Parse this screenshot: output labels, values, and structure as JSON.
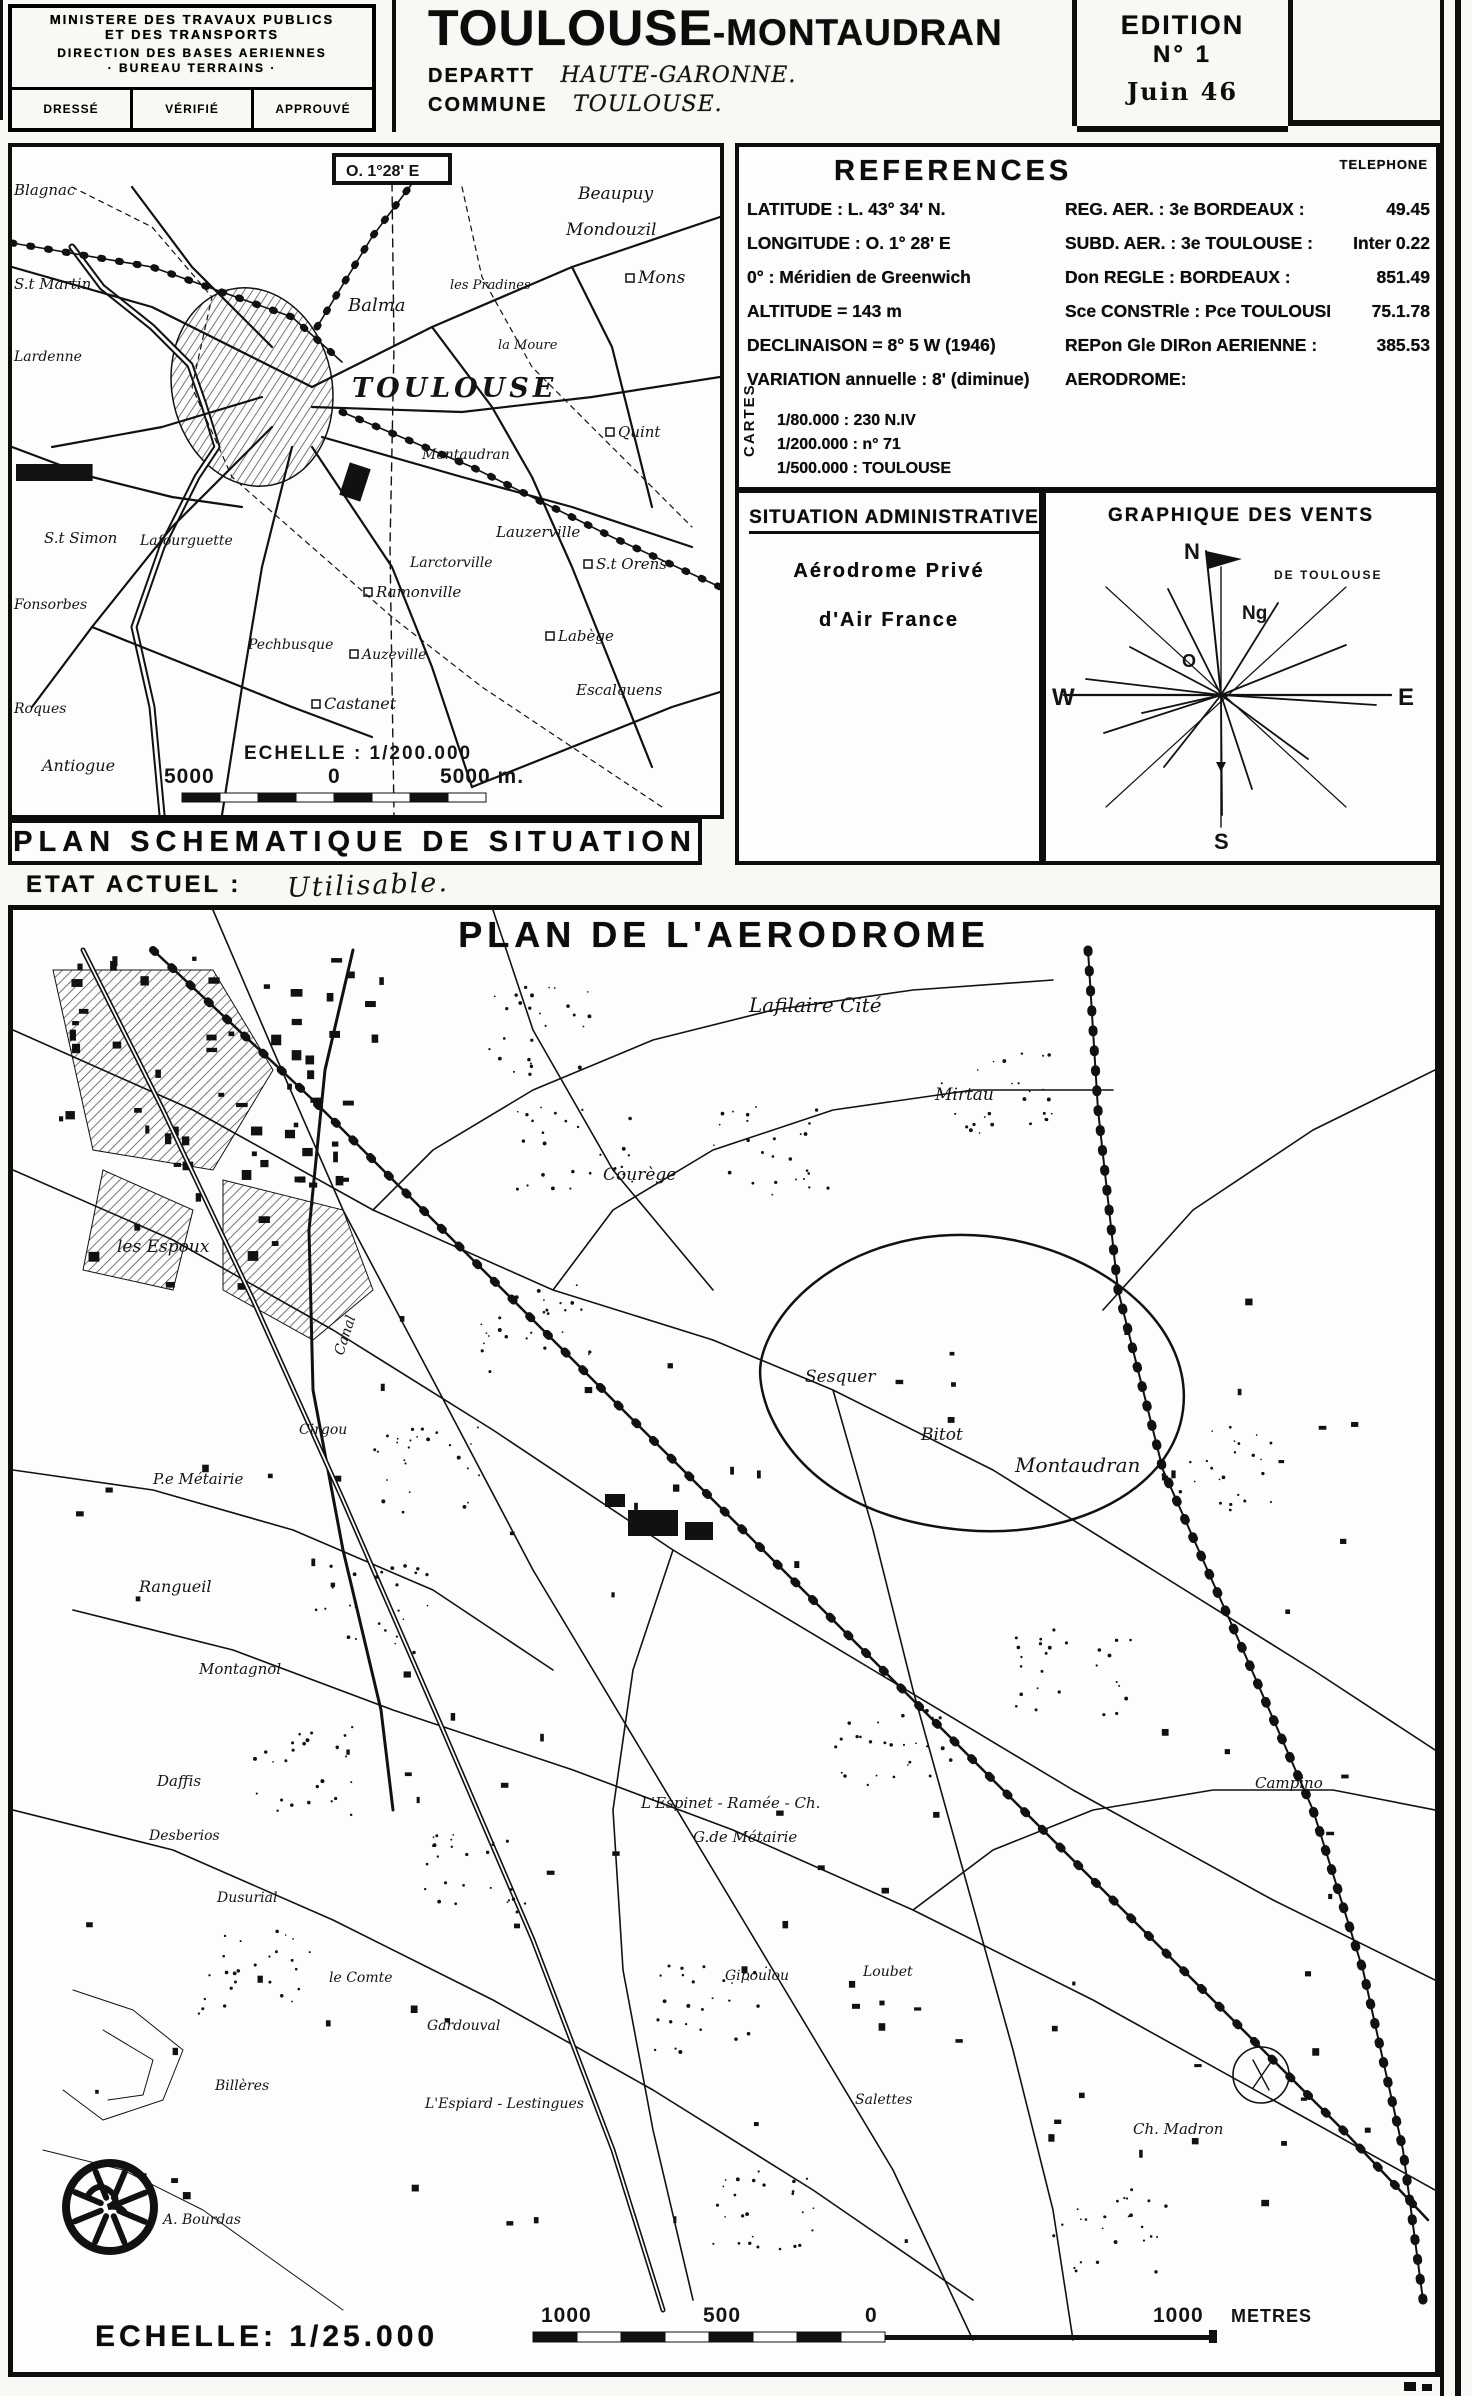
{
  "header": {
    "stamp": {
      "line1": "MINISTERE DES TRAVAUX PUBLICS",
      "line2": "ET DES TRANSPORTS",
      "line3": "DIRECTION DES BASES AERIENNES",
      "line4": "· BUREAU TERRAINS ·",
      "cells": [
        "DRESSÉ",
        "VÉRIFIÉ",
        "APPROUVÉ"
      ]
    },
    "title_main": "TOULOUSE",
    "title_suffix": "-MONTAUDRAN",
    "dept_label": "DEPARTT",
    "dept_value": "HAUTE-GARONNE.",
    "commune_label": "COMMUNE",
    "commune_value": "TOULOUSE.",
    "edition": {
      "line1": "EDITION",
      "line2": "N° 1",
      "line3": "Juin 46"
    }
  },
  "references": {
    "title": "REFERENCES",
    "phone_header": "TELEPHONE",
    "rows": [
      {
        "left": "LATITUDE : L. 43° 34' N.",
        "right": "REG. AER. : 3e BORDEAUX :",
        "phone": "49.45"
      },
      {
        "left": "LONGITUDE : O. 1° 28' E",
        "right": "SUBD. AER. : 3e TOULOUSE :",
        "phone": "Inter 0.22"
      },
      {
        "left": "0° : Méridien de Greenwich",
        "right": "Don REGLE : BORDEAUX :",
        "phone": "851.49"
      },
      {
        "left": "ALTITUDE = 143 m",
        "right": "Sce CONSTRle : Pce TOULOUSE :",
        "phone": "75.1.78"
      },
      {
        "left": "DECLINAISON = 8° 5 W (1946)",
        "right": "REPon Gle DIRon AERIENNE :",
        "phone": "385.53"
      },
      {
        "left": "VARIATION annuelle : 8' (diminue)",
        "right": "AERODROME:",
        "phone": ""
      }
    ],
    "cartes_label": "CARTES",
    "cartes_rows": [
      "1/80.000 : 230 N.IV",
      "1/200.000 : n° 71",
      "1/500.000 : TOULOUSE"
    ]
  },
  "situation_administrative": {
    "title": "SITUATION ADMINISTRATIVE",
    "line1": "Aérodrome Privé",
    "line2": "d'Air France"
  },
  "winds": {
    "title": "GRAPHIQUE DES VENTS",
    "subtitle": "DE TOULOUSE",
    "compass": {
      "n": "N",
      "ng": "Ng",
      "o": "O",
      "w": "W",
      "e": "E",
      "s": "S"
    }
  },
  "situation_map": {
    "banner": "PLAN SCHEMATIQUE DE SITUATION",
    "meridian_label": "O. 1°28' E",
    "scale_label": "ECHELLE : 1/200.000",
    "scale_ticks": [
      {
        "t": "5000",
        "x": 152
      },
      {
        "t": "0",
        "x": 316
      },
      {
        "t": "5000 m.",
        "x": 428
      }
    ],
    "labels": [
      {
        "t": "Blagnac",
        "x": 2,
        "y": 48,
        "s": 15
      },
      {
        "t": "S.t Martin",
        "x": 2,
        "y": 142,
        "s": 15
      },
      {
        "t": "Lardenne",
        "x": 2,
        "y": 214,
        "s": 14
      },
      {
        "t": "Beaupuy",
        "x": 566,
        "y": 52,
        "s": 17
      },
      {
        "t": "Mondouzil",
        "x": 554,
        "y": 88,
        "s": 17
      },
      {
        "t": "Mons",
        "x": 626,
        "y": 136,
        "s": 17,
        "m": 1
      },
      {
        "t": "Balma",
        "x": 336,
        "y": 164,
        "s": 18
      },
      {
        "t": "les Pradines",
        "x": 438,
        "y": 142,
        "s": 13
      },
      {
        "t": "la Moure",
        "x": 486,
        "y": 202,
        "s": 13
      },
      {
        "t": "TOULOUSE",
        "x": 340,
        "y": 250,
        "s": 27,
        "st": "big"
      },
      {
        "t": "Quint",
        "x": 606,
        "y": 290,
        "s": 15,
        "m": 1
      },
      {
        "t": "Montaudran",
        "x": 410,
        "y": 312,
        "s": 14
      },
      {
        "t": "LA REYNIE",
        "x": 4,
        "y": 330,
        "s": 12,
        "st": "inv"
      },
      {
        "t": "S.t Simon",
        "x": 32,
        "y": 396,
        "s": 15
      },
      {
        "t": "Lafourguette",
        "x": 128,
        "y": 398,
        "s": 14
      },
      {
        "t": "Lauzerville",
        "x": 484,
        "y": 390,
        "s": 15
      },
      {
        "t": "Larctorville",
        "x": 398,
        "y": 420,
        "s": 14
      },
      {
        "t": "S.t Orens",
        "x": 584,
        "y": 422,
        "s": 15,
        "m": 1
      },
      {
        "t": "Ramonville",
        "x": 364,
        "y": 450,
        "s": 15,
        "m": 1
      },
      {
        "t": "Pechbusque",
        "x": 236,
        "y": 502,
        "s": 14
      },
      {
        "t": "Auzeville",
        "x": 350,
        "y": 512,
        "s": 14,
        "m": 1
      },
      {
        "t": "Labège",
        "x": 546,
        "y": 494,
        "s": 15,
        "m": 1
      },
      {
        "t": "Escalquens",
        "x": 564,
        "y": 548,
        "s": 15
      },
      {
        "t": "Castanet",
        "x": 312,
        "y": 562,
        "s": 16,
        "m": 1
      },
      {
        "t": "Fonsorbes",
        "x": 2,
        "y": 462,
        "s": 14
      },
      {
        "t": "Roques",
        "x": 2,
        "y": 566,
        "s": 14
      },
      {
        "t": "Antiogue",
        "x": 30,
        "y": 624,
        "s": 16
      }
    ]
  },
  "etat": {
    "label": "ETAT ACTUEL :",
    "value": "Utilisable."
  },
  "aerodrome_map": {
    "title": "PLAN DE L'AERODROME",
    "scale_label": "ECHELLE: 1/25.000",
    "scale_ticks": [
      {
        "t": "1000",
        "x": 528
      },
      {
        "t": "500",
        "x": 690
      },
      {
        "t": "0",
        "x": 852
      },
      {
        "t": "1000",
        "x": 1140
      },
      {
        "t": "METRES",
        "x": 1218
      }
    ],
    "labels": [
      {
        "t": "Lafilaire Cité",
        "x": 736,
        "y": 102,
        "s": 20
      },
      {
        "t": "Mirtau",
        "x": 922,
        "y": 190,
        "s": 17
      },
      {
        "t": "Courège",
        "x": 590,
        "y": 270,
        "s": 17
      },
      {
        "t": "les Espoux",
        "x": 104,
        "y": 342,
        "s": 17
      },
      {
        "t": "Canal",
        "x": 330,
        "y": 446,
        "s": 14,
        "r": -72
      },
      {
        "t": "Sesquer",
        "x": 792,
        "y": 472,
        "s": 17
      },
      {
        "t": "Bitot",
        "x": 908,
        "y": 530,
        "s": 17
      },
      {
        "t": "Montaudran",
        "x": 1002,
        "y": 562,
        "s": 20
      },
      {
        "t": "Cirgou",
        "x": 286,
        "y": 524,
        "s": 14
      },
      {
        "t": "P.e Métairie",
        "x": 140,
        "y": 574,
        "s": 15
      },
      {
        "t": "Rangueil",
        "x": 126,
        "y": 682,
        "s": 16
      },
      {
        "t": "Montagnol",
        "x": 186,
        "y": 764,
        "s": 15
      },
      {
        "t": "Daffis",
        "x": 144,
        "y": 876,
        "s": 15
      },
      {
        "t": "Desberios",
        "x": 136,
        "y": 930,
        "s": 14
      },
      {
        "t": "Dusurial",
        "x": 204,
        "y": 992,
        "s": 14
      },
      {
        "t": "le Comte",
        "x": 316,
        "y": 1072,
        "s": 14
      },
      {
        "t": "Gardouval",
        "x": 414,
        "y": 1120,
        "s": 14
      },
      {
        "t": "L'Espinet - Ramée - Ch.",
        "x": 628,
        "y": 898,
        "s": 15
      },
      {
        "t": "G.de Métairie",
        "x": 680,
        "y": 932,
        "s": 15
      },
      {
        "t": "Gipoulou",
        "x": 712,
        "y": 1070,
        "s": 14
      },
      {
        "t": "Loubet",
        "x": 850,
        "y": 1066,
        "s": 14
      },
      {
        "t": "Salettes",
        "x": 842,
        "y": 1194,
        "s": 14
      },
      {
        "t": "L'Espiard - Lestingues",
        "x": 412,
        "y": 1198,
        "s": 14
      },
      {
        "t": "Billères",
        "x": 202,
        "y": 1180,
        "s": 14
      },
      {
        "t": "A. Bourdas",
        "x": 150,
        "y": 1314,
        "s": 14
      },
      {
        "t": "Campino",
        "x": 1242,
        "y": 878,
        "s": 15
      },
      {
        "t": "Ch. Madron",
        "x": 1120,
        "y": 1224,
        "s": 15
      }
    ]
  }
}
